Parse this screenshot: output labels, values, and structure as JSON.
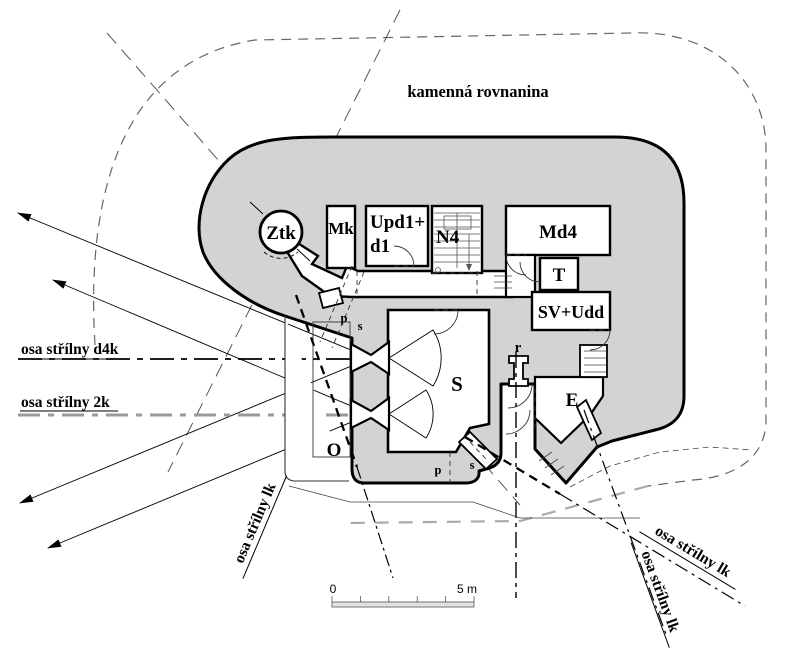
{
  "title": "kamenná rovnanina",
  "rooms": {
    "ztk": "Ztk",
    "mk": "Mk",
    "upd_line1": "Upd1+",
    "upd_line2": "d1",
    "n4": "N4",
    "md4": "Md4",
    "t": "T",
    "sv_udd": "SV+Udd",
    "s_room": "S",
    "e_room": "E",
    "o_area": "O",
    "r_shaft": "r"
  },
  "marks": {
    "p_upper": "p",
    "s_upper": "s",
    "p_lower": "p",
    "s_lower": "s"
  },
  "axis_labels": {
    "d4k": "osa střílny d4k",
    "k2": "osa střílny 2k",
    "lk_sw": "osa střílny lk",
    "lk_se_upper": "osa střílny lk",
    "lk_se_lower": "osa střílny lk"
  },
  "scale_bar": {
    "zero": "0",
    "five_m": "5 m"
  },
  "colors": {
    "wall_fill": "#d3d3d3",
    "outline": "#000000",
    "axis_2k_gray": "#9a9a9a",
    "boundary_dash": "#666666",
    "bottom_boundary_gray": "#aaaaaa"
  }
}
